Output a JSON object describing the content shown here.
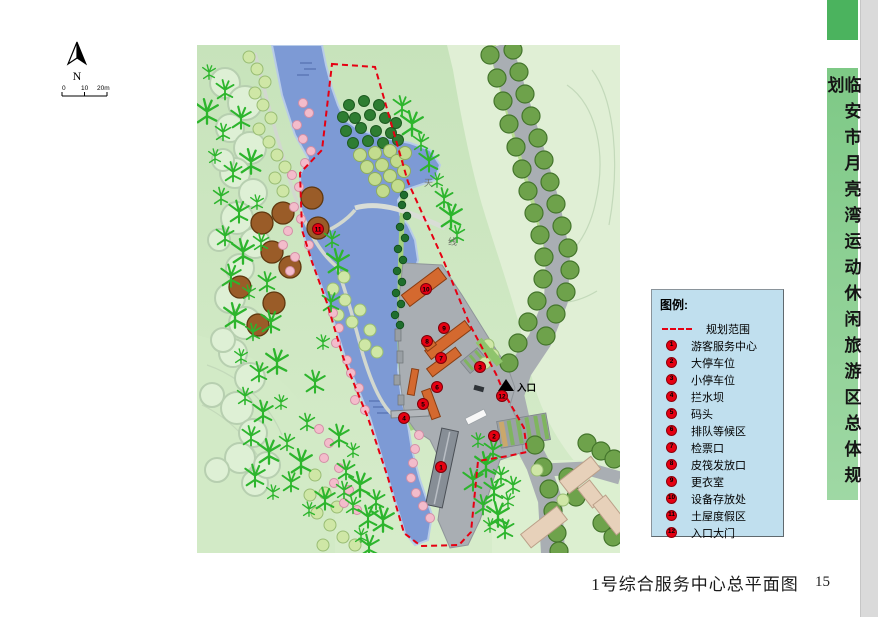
{
  "page": {
    "number": "15",
    "bg": "#ffffff",
    "edge_strip_color": "#dadada"
  },
  "sidebar": {
    "title": "临安市月亮湾运动休闲旅游区总体规划",
    "top_block_color": "#4bb35e",
    "bar_color": "#8fd096"
  },
  "compass": {
    "label": "N"
  },
  "scale_bar": {
    "labels": [
      "0",
      "10",
      "20m"
    ]
  },
  "legend": {
    "title": "图例:",
    "bg": "#c0dfee",
    "badge_color": "#e60012",
    "boundary": {
      "label": "规划范围",
      "color": "#e60012"
    },
    "items": [
      {
        "num": "1",
        "label": "游客服务中心"
      },
      {
        "num": "2",
        "label": "大停车位"
      },
      {
        "num": "3",
        "label": "小停车位"
      },
      {
        "num": "4",
        "label": "拦水坝"
      },
      {
        "num": "5",
        "label": "码头"
      },
      {
        "num": "6",
        "label": "排队等候区"
      },
      {
        "num": "7",
        "label": "检票口"
      },
      {
        "num": "8",
        "label": "皮筏发放口"
      },
      {
        "num": "9",
        "label": "更衣室"
      },
      {
        "num": "10",
        "label": "设备存放处"
      },
      {
        "num": "11",
        "label": "土屋度假区"
      },
      {
        "num": "12",
        "label": "入口大门"
      }
    ]
  },
  "map": {
    "entrance_label": "入口",
    "road_labels": [
      {
        "text": "天",
        "x": 227,
        "y": 141
      },
      {
        "text": "线",
        "x": 251,
        "y": 200
      }
    ],
    "markers": [
      {
        "num": "1",
        "x": 244,
        "y": 422
      },
      {
        "num": "2",
        "x": 297,
        "y": 391
      },
      {
        "num": "3",
        "x": 283,
        "y": 322
      },
      {
        "num": "4",
        "x": 207,
        "y": 373
      },
      {
        "num": "5",
        "x": 226,
        "y": 359
      },
      {
        "num": "6",
        "x": 240,
        "y": 342
      },
      {
        "num": "7",
        "x": 244,
        "y": 313
      },
      {
        "num": "8",
        "x": 230,
        "y": 296
      },
      {
        "num": "9",
        "x": 247,
        "y": 283
      },
      {
        "num": "10",
        "x": 229,
        "y": 244
      },
      {
        "num": "11",
        "x": 121,
        "y": 184
      },
      {
        "num": "12",
        "x": 305,
        "y": 351
      }
    ],
    "colors": {
      "water": "#7d9ad5",
      "boundary": "#e60012",
      "road": "#a9aeb3",
      "building_orange": "#d4692f",
      "building_gray": "#8a9199",
      "building_beige": "#e7d1ba",
      "marker": "#e60012"
    }
  },
  "caption": {
    "text": "1号综合服务中心总平面图"
  }
}
